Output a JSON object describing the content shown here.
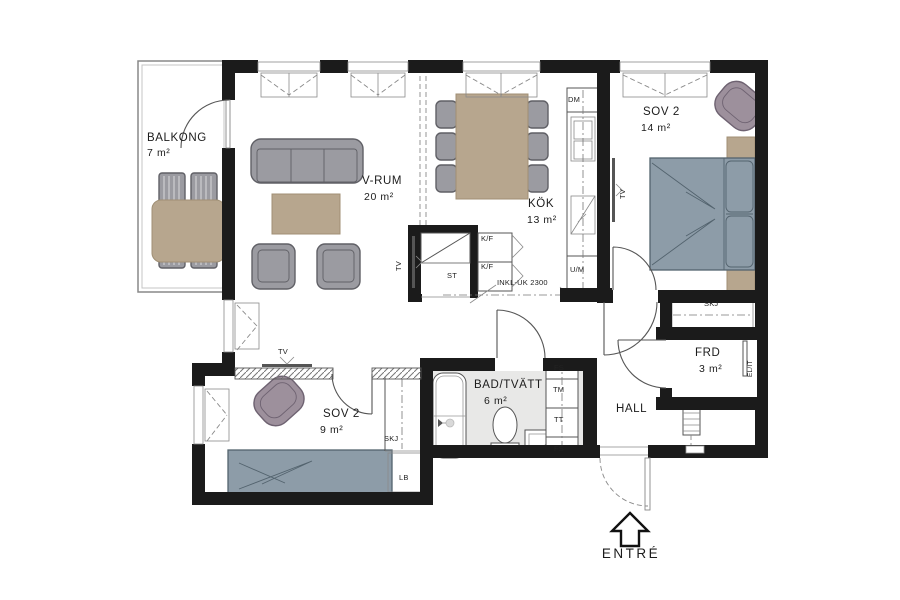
{
  "rooms": {
    "balkong": {
      "name": "BALKONG",
      "area": "7 m²"
    },
    "vrum": {
      "name": "V-RUM",
      "area": "20 m²"
    },
    "kok": {
      "name": "KÖK",
      "area": "13 m²"
    },
    "sov2_stor": {
      "name": "SOV 2",
      "area": "14 m²"
    },
    "sov2_liten": {
      "name": "SOV 2",
      "area": "9 m²"
    },
    "bad_tvatt": {
      "name": "BAD/TVÄTT",
      "area": "6 m²"
    },
    "hall": {
      "name": "HALL"
    },
    "frd": {
      "name": "FRD",
      "area": "3 m²"
    }
  },
  "entrance": {
    "label": "ENTRÉ"
  },
  "fixtures": {
    "dm": "DM",
    "um": "U/M",
    "kf": "K/F",
    "st": "ST",
    "tv": "TV",
    "skj": "SKJ",
    "lb": "LB",
    "fs": "FS",
    "tm": "TM",
    "tt": "TT",
    "el_it": "EL/IT",
    "opening_note": "INKL-UK 2300"
  },
  "colors": {
    "wall": "#1b1b1b",
    "furniture": "#9b9ba1",
    "furniture_line": "#606066",
    "wood": "#b7a68e",
    "wood_line": "#a08f74",
    "bed": "#8d9ca8",
    "bed_line": "#53636e",
    "accent_chair": "#9d909c",
    "accent_line": "#6e6271",
    "bath_floor": "#e8e8e7"
  }
}
